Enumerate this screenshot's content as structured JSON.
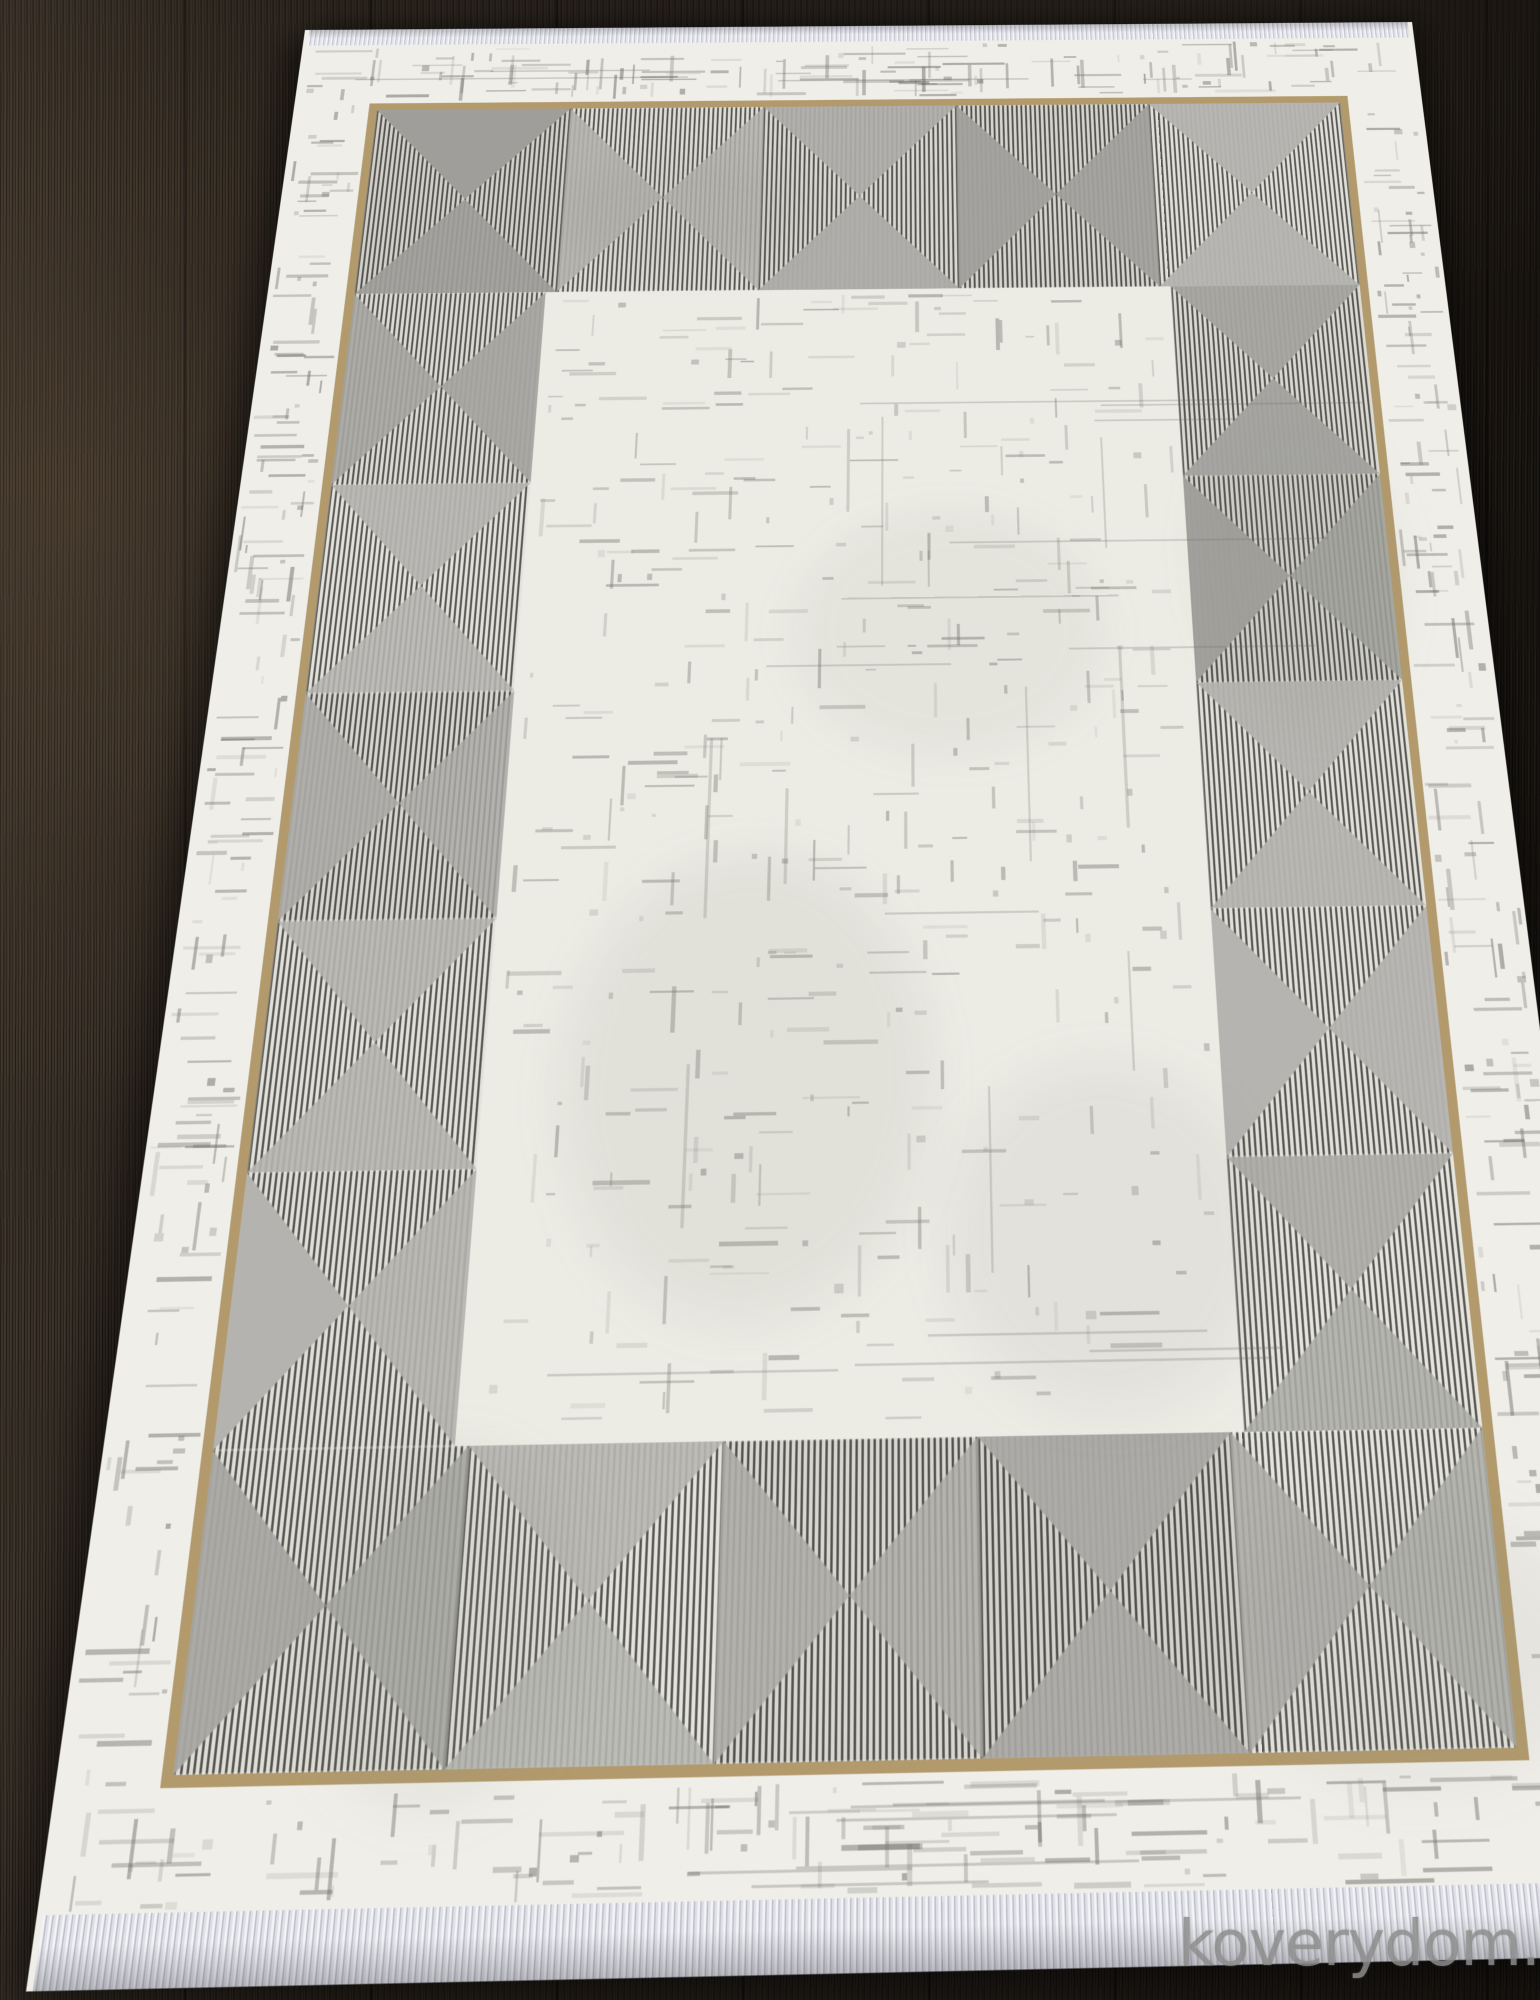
{
  "watermark": {
    "text": "koverydom.ru"
  },
  "colors": {
    "floor": "#241e19",
    "rug_ivory": "#efeee8",
    "field_ivory": "#ecebe4",
    "gold": "#b29a6c",
    "stripe_dark": "#55544f",
    "stripe_light": "#dcdbd5",
    "triangle_gray": "#a7a6a2",
    "triangle_gray_alt": "#b1b0ac",
    "distress_gray": "#6e6e68",
    "fringe_light": "#f3f4f8",
    "fringe_dark": "#bcbdc7"
  }
}
